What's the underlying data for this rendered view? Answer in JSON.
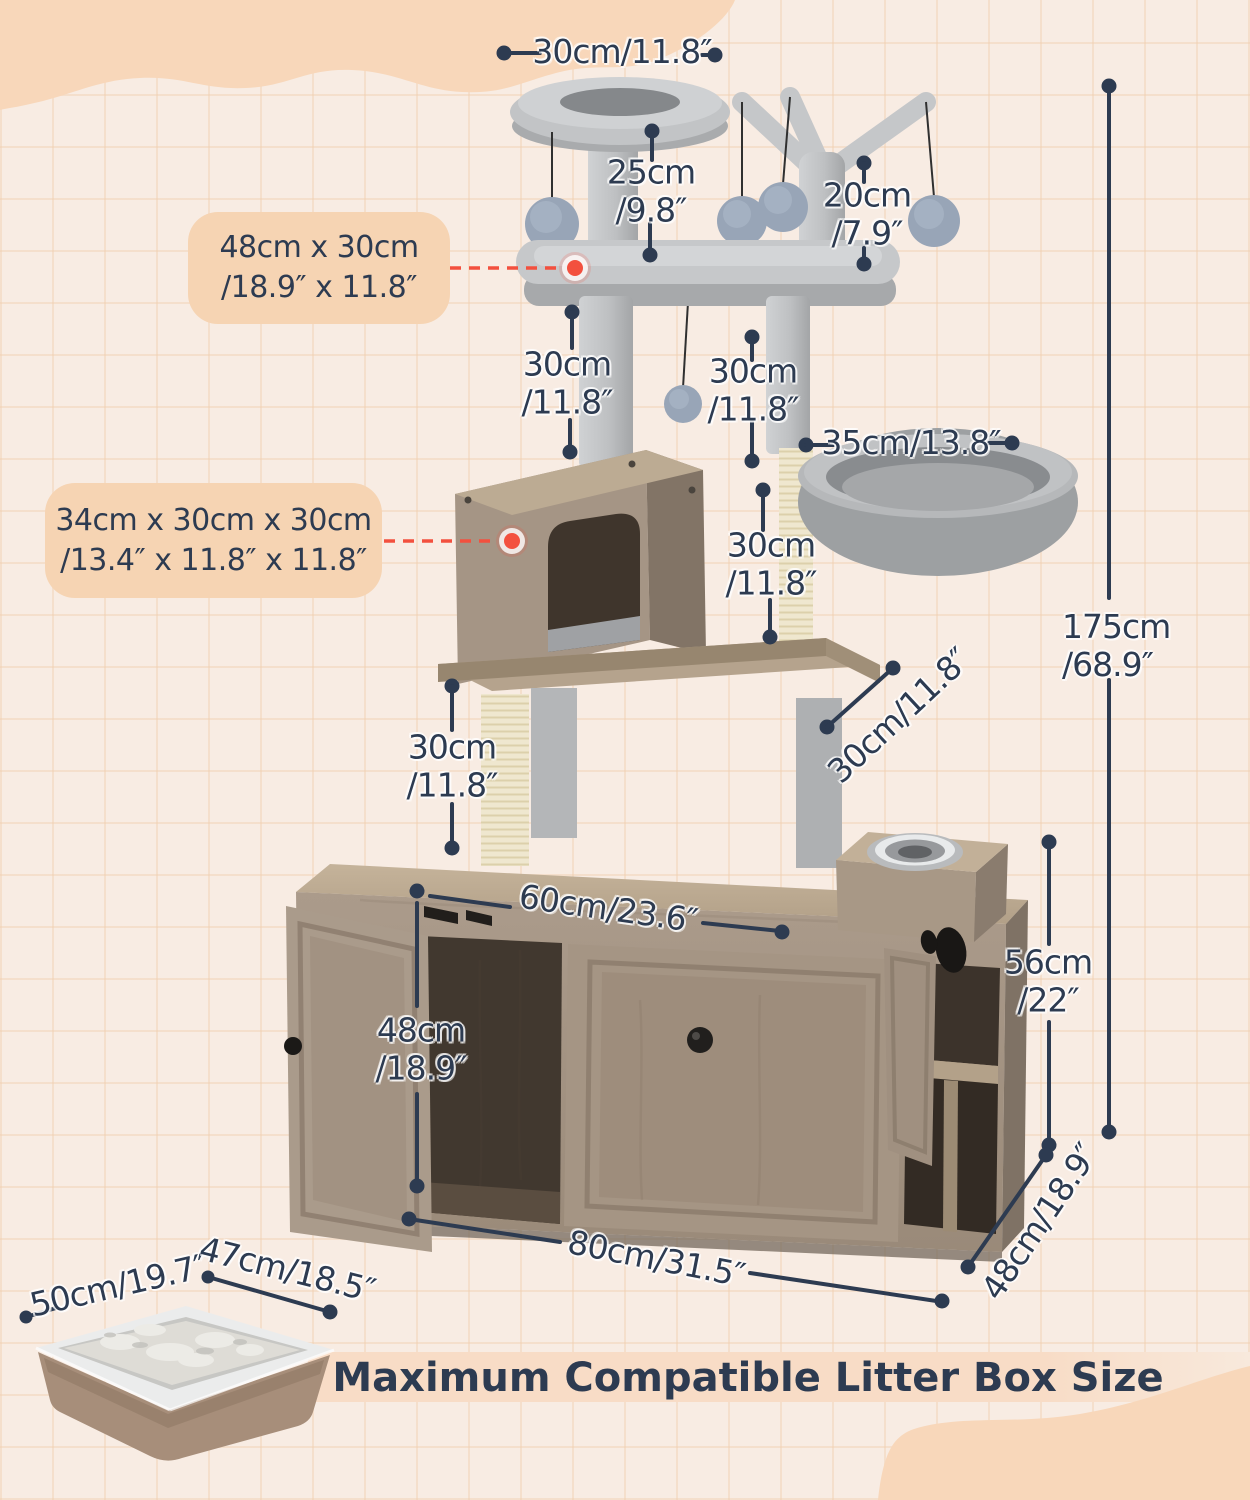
{
  "colors": {
    "background": "#f8ece3",
    "grid_line": "#f0cdad",
    "blob_peach": "#f8d7ba",
    "callout_bg": "#f6d4b3",
    "banner_bg": "#f8dcc6",
    "text_navy": "#2d3b51",
    "accent_red": "#f3503e",
    "plush_gray": "#c6c8ca",
    "wood": "#a79786",
    "sisal": "#efe7cf"
  },
  "callouts": {
    "bed": "48cm x 30cm\n/18.9″ x 11.8″",
    "condo": "34cm x 30cm x 30cm\n/13.4″ x 11.8″ x 11.8″"
  },
  "dimensions": {
    "top_perch_width": "30cm/11.8″",
    "top_post_height": "25cm\n/9.8″",
    "branch_height": "20cm\n/7.9″",
    "left_post_height": "30cm\n/11.8″",
    "right_post_height": "30cm\n/11.8″",
    "basket_post_height": "30cm\n/11.8″",
    "basket_width": "35cm/13.8″",
    "total_height": "175cm\n/68.9″",
    "lower_post_height": "30cm\n/11.8″",
    "platform_depth": "30cm/11.8″",
    "inner_width": "60cm/23.6″",
    "inner_height": "48cm\n/18.9″",
    "cabinet_height": "56cm\n/22″",
    "cabinet_width": "80cm/31.5″",
    "cabinet_depth": "48cm/18.9″",
    "litter_box_length": "50cm/19.7″",
    "litter_box_width": "47cm/18.5″"
  },
  "banner": {
    "text": "Maximum Compatible Litter Box Size"
  }
}
